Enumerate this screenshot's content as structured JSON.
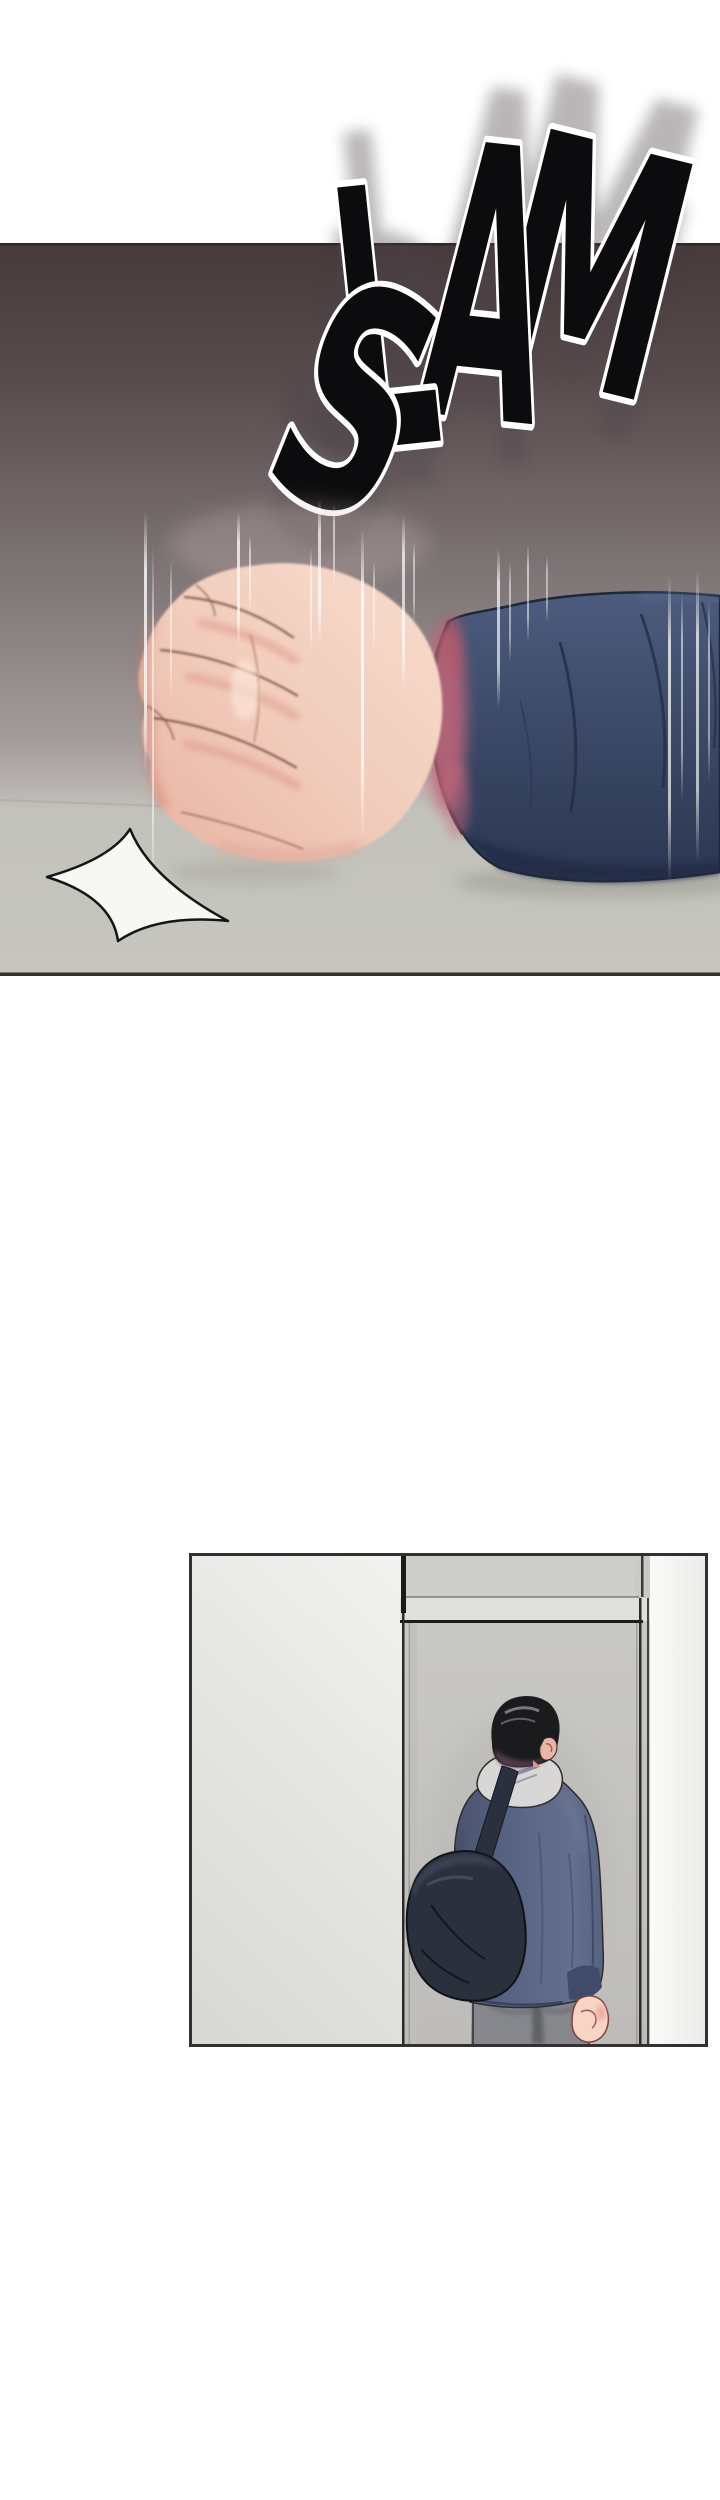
{
  "page": {
    "width": 720,
    "height": 2500,
    "background": "#ffffff",
    "type": "webtoon episode page (vertical scroll comic)"
  },
  "sfx": {
    "text": "SLAM",
    "letters": [
      "S",
      "L",
      "A",
      "M"
    ]
  },
  "panels": [
    {
      "id": "panel-1",
      "label": "impact-panel",
      "description": "A fist slams down onto a desk; arm in a navy sleeve enters from the right, vertical speed lines, white impact star on the desk, SLAM sound effect overlapping the panel top edge",
      "sfx": "SLAM",
      "y": 243,
      "height": 733
    },
    {
      "id": "panel-2",
      "label": "doorway-panel",
      "description": "Young man with black hair, light gray hood, blue jacket, dark shoulder bag and gray pants stands with his back to the viewer facing a closed gray door",
      "x": 189,
      "y": 1553,
      "width": 519,
      "height": 494
    }
  ],
  "colors": {
    "page_bg": "#ffffff",
    "panel_border": "#323030",
    "wall_top": "#463a3b",
    "wall_mid": "#746a6b",
    "wall_low": "#a49d9c",
    "wall_end": "#bab4b1",
    "desk": "#c6c6bf",
    "desk_line": "#a8a49c",
    "sfx_fill": "#0c0c0e",
    "sfx_outline": "#ffffff",
    "sfx_ghost": "#4b4346",
    "speed_line": "#ffffff",
    "skin": "#f2cdbc",
    "skin_hi": "#f7dccd",
    "skin_sh": "#e8b3a2",
    "knuckle": "#7a4a42",
    "flush": "#dd9a8d",
    "wrist_red": "#c4687a",
    "sleeve_hi": "#4d5c7e",
    "sleeve": "#3c4a68",
    "sleeve_dark": "#2b3752",
    "sleeve_line": "#1f2838",
    "star_fill": "#f7f7f4",
    "star_line": "#161616",
    "p2_wall_a": "#fcfcfa",
    "p2_wall_b": "#d7d7d4",
    "p2_transom": "#cdcdc9",
    "p2_band": "#dfdfdb",
    "p2_band_line": "#1b1b19",
    "p2_frame": "#2a2a28",
    "p2_frame_light": "#96968e",
    "p2_door_a": "#cbcac6",
    "p2_door_b": "#bdbcb8",
    "p2_wall_right_a": "#fafaf8",
    "p2_wall_right_b": "#ebebe9",
    "hair": "#1b1b1e",
    "hair_shine": "#90909a",
    "hair_tint": "#5c4150",
    "face_skin": "#eab5a6",
    "hood": "#d8d7d5",
    "hood_fold": "#8a90a8",
    "outline_dark": "#2c2c2e",
    "jacket": "#5b6586",
    "jacket_hi": "#6f7996",
    "jacket_dark": "#3d4866",
    "cuff": "#404b6b",
    "strap": "#2b303e",
    "bag": "#2b303d",
    "bag_hi": "#3d4455",
    "bag_line": "#121623",
    "bag_outline": "#0f1219",
    "pants": "#85878c",
    "pants_shadow": "#606268",
    "hand": "#f8d4c4",
    "hand_line": "#7e443c"
  }
}
